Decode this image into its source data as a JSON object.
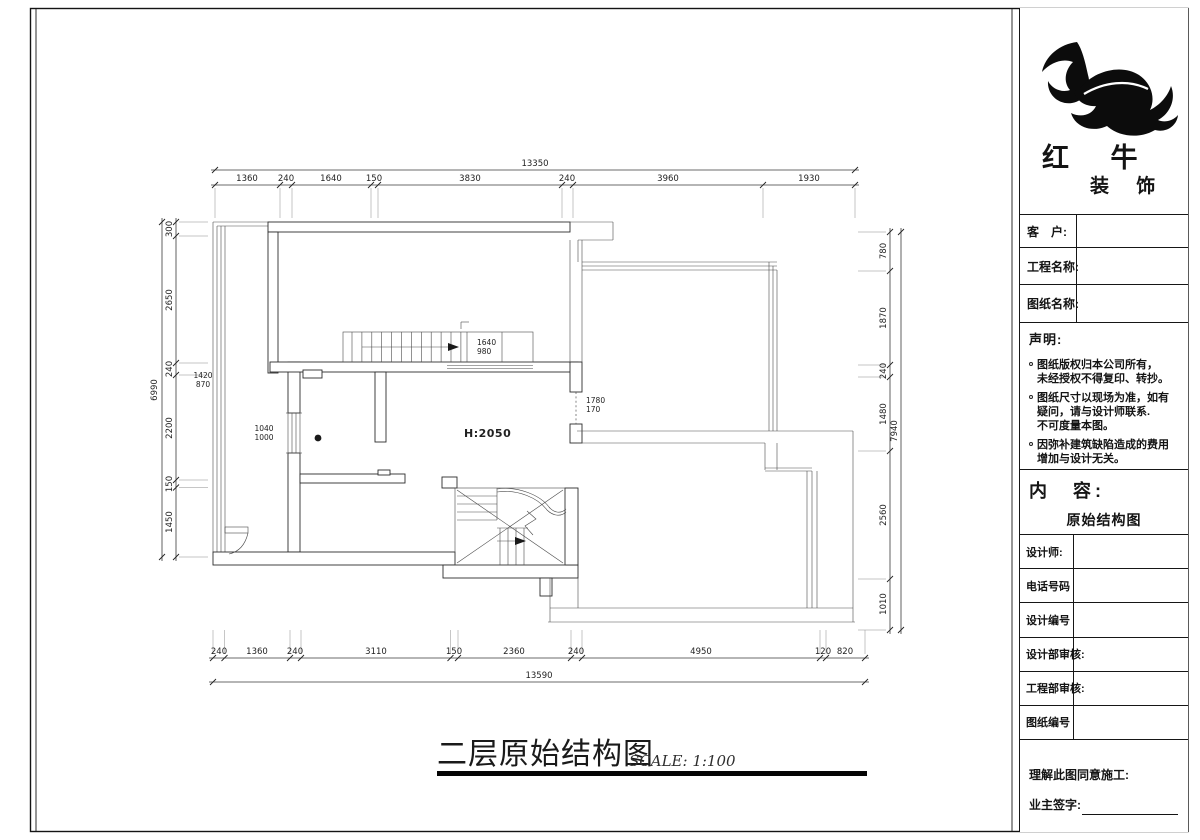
{
  "colors": {
    "ink": "#1a1a1a",
    "line": "#4a4a4a"
  },
  "drawing": {
    "title": "二层原始结构图",
    "scale": "SCALE: 1:100",
    "labels": {
      "height": "H:2050",
      "stair_top": "1640",
      "stair_bottom": "980",
      "opening_top": "1780",
      "opening_bottom": "170",
      "window_top": "1040",
      "window_bottom": "1000",
      "left_top": "1420",
      "left_bottom": "870"
    },
    "dims": {
      "top_total": "13350",
      "top": [
        "1360",
        "240",
        "1640",
        "150",
        "3830",
        "240",
        "3960",
        "1930"
      ],
      "bottom": [
        "240",
        "1360",
        "240",
        "3110",
        "150",
        "2360",
        "240",
        "4950",
        "120",
        "820"
      ],
      "bottom_total": "13590",
      "left": [
        "300",
        "2650",
        "240",
        "2200",
        "150",
        "1450"
      ],
      "left_total": "6990",
      "right": [
        "780",
        "1870",
        "240",
        "1480",
        "2560",
        "1010"
      ],
      "right_total": "7940"
    }
  },
  "brand": {
    "line1": "红 牛",
    "line2": "装 饰"
  },
  "title_block": {
    "fields": [
      {
        "label": "客　户:"
      },
      {
        "label": "工程名称:"
      },
      {
        "label": "图纸名称:"
      }
    ],
    "declaration": {
      "heading": "声明:",
      "items": [
        {
          "lines": [
            "图纸版权归本公司所有，",
            "未经授权不得复印、转抄。"
          ]
        },
        {
          "lines": [
            "图纸尺寸以现场为准，如有",
            "疑问，请与设计师联系.",
            "不可度量本图。"
          ]
        },
        {
          "lines": [
            "因弥补建筑缺陷造成的费用",
            "增加与设计无关。"
          ]
        }
      ]
    },
    "content": {
      "label": "内　容:",
      "value": "原始结构图"
    },
    "rows": [
      {
        "label": "设计师:"
      },
      {
        "label": "电话号码"
      },
      {
        "label": "设计编号"
      },
      {
        "label": "设计部审核:"
      },
      {
        "label": "工程部审核:"
      },
      {
        "label": "图纸编号"
      }
    ],
    "footer": {
      "line1": "理解此图同意施工:",
      "line2": "业主签字:"
    }
  }
}
